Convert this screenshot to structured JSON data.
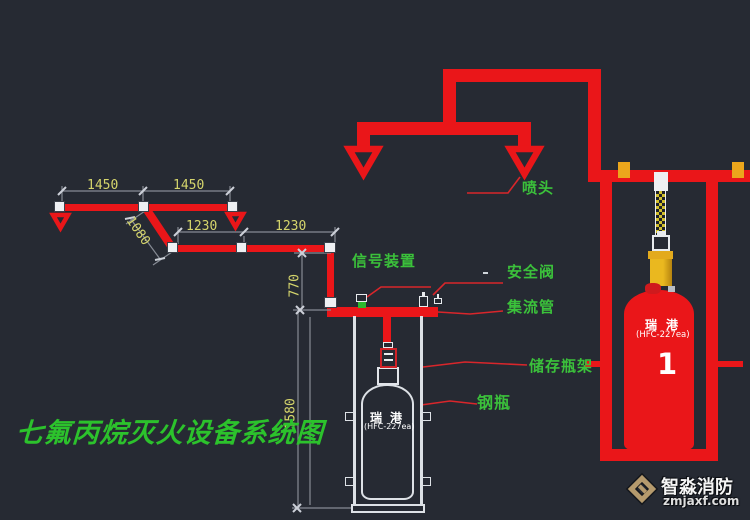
{
  "title": {
    "text": "七氟丙烷灭火设备系统图"
  },
  "labels": {
    "nozzle": "喷头",
    "signal_device": "信号装置",
    "safety_valve": "安全阀",
    "manifold": "集流管",
    "storage_rack": "储存瓶架",
    "steel_cylinder": "钢瓶"
  },
  "dimensions": {
    "span_a1": "1450",
    "span_a2": "1450",
    "drop": "1080",
    "span_b1": "1230",
    "span_b2": "1230",
    "rise": "770",
    "height": "1580"
  },
  "cylinders": {
    "right": {
      "brand": "瑞港",
      "model": "(HFC-227ea)",
      "number": "1"
    },
    "left": {
      "brand": "瑞港",
      "model": "(HFC-227ea)"
    }
  },
  "watermark": {
    "brand": "智淼消防",
    "site": "zmjaxf.com"
  },
  "colors": {
    "background": "#262a33",
    "pipe_red": "#ea1619",
    "label_green": "#3bc13b",
    "title_green": "#2cc22c",
    "dim_yellow": "#d5d56c",
    "dim_gray": "#868b94",
    "brass": "#e3aa1d",
    "clamp_amber": "#eca61c",
    "hose_yellow": "#d2c02c",
    "logo_tan": "#b59a6d"
  }
}
